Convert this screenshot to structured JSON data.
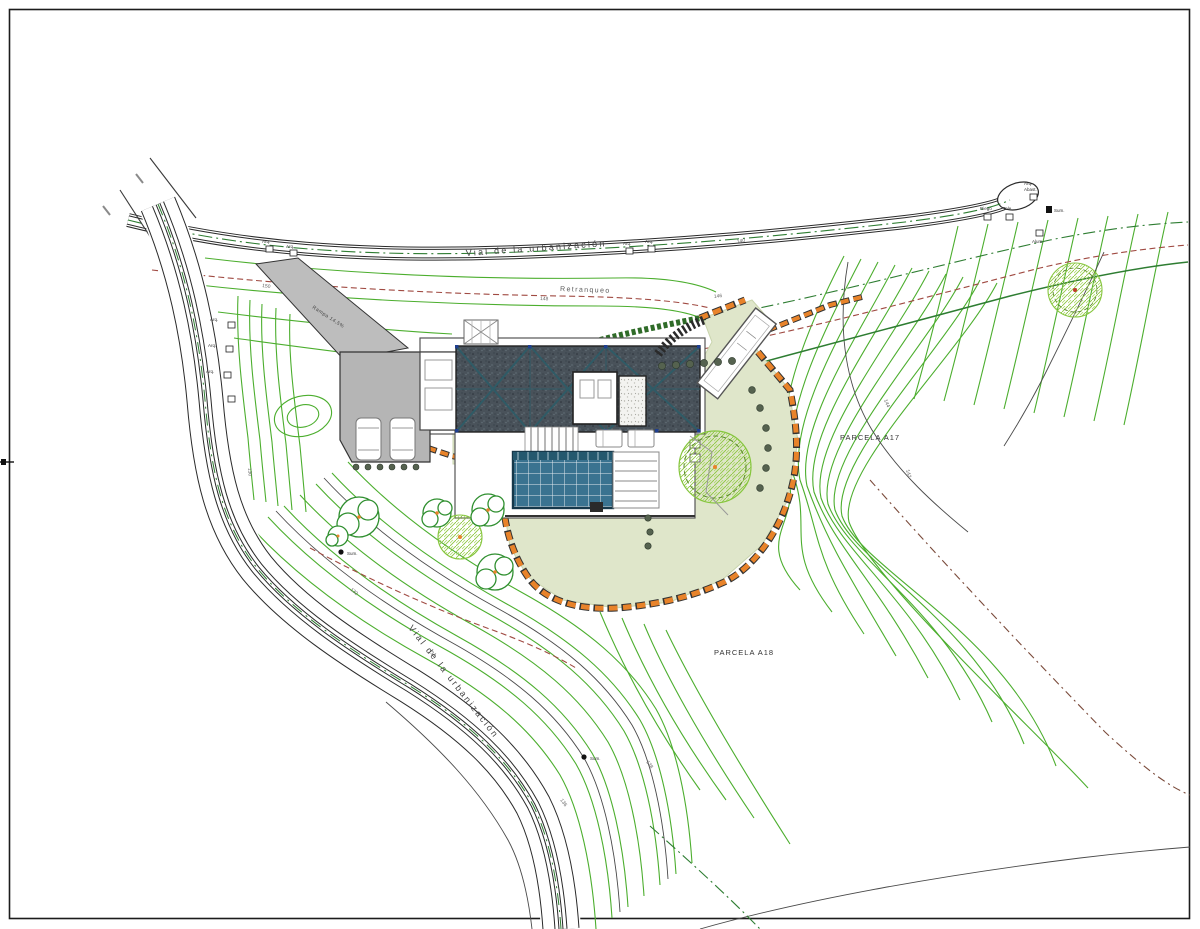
{
  "labels": {
    "road_top": "Vial de la urbanización",
    "road_bottom": "Vial de la urbanización",
    "setback": "Retranqueo",
    "parcel_right": "PARCELA A17",
    "parcel_bottom": "PARCELA A18",
    "ramp": "Rampa 14,5%"
  },
  "utilities": {
    "arq": "Arq.",
    "abast": "Abast.",
    "riego": "Riego",
    "tele": "Tele",
    "alum": "Alum.",
    "sum": "Sum."
  },
  "contour_labels": [
    "150",
    "148",
    "146",
    "144",
    "142",
    "140",
    "138",
    "136",
    "134",
    "132",
    "130"
  ],
  "colors": {
    "contour_green": "#4cae2e",
    "boundary_dark_green": "#2e7d32",
    "stone_wall_orange": "#e8832a",
    "setback_red": "#a04a42",
    "pool_teal": "#3a7390",
    "roof_dark": "#49525a",
    "driveway_gray": "#b5b5b5",
    "lawn_sage": "#dfe6ca",
    "tree_green": "#2f8f2f",
    "tree_hatch_green": "#8dc63f"
  }
}
